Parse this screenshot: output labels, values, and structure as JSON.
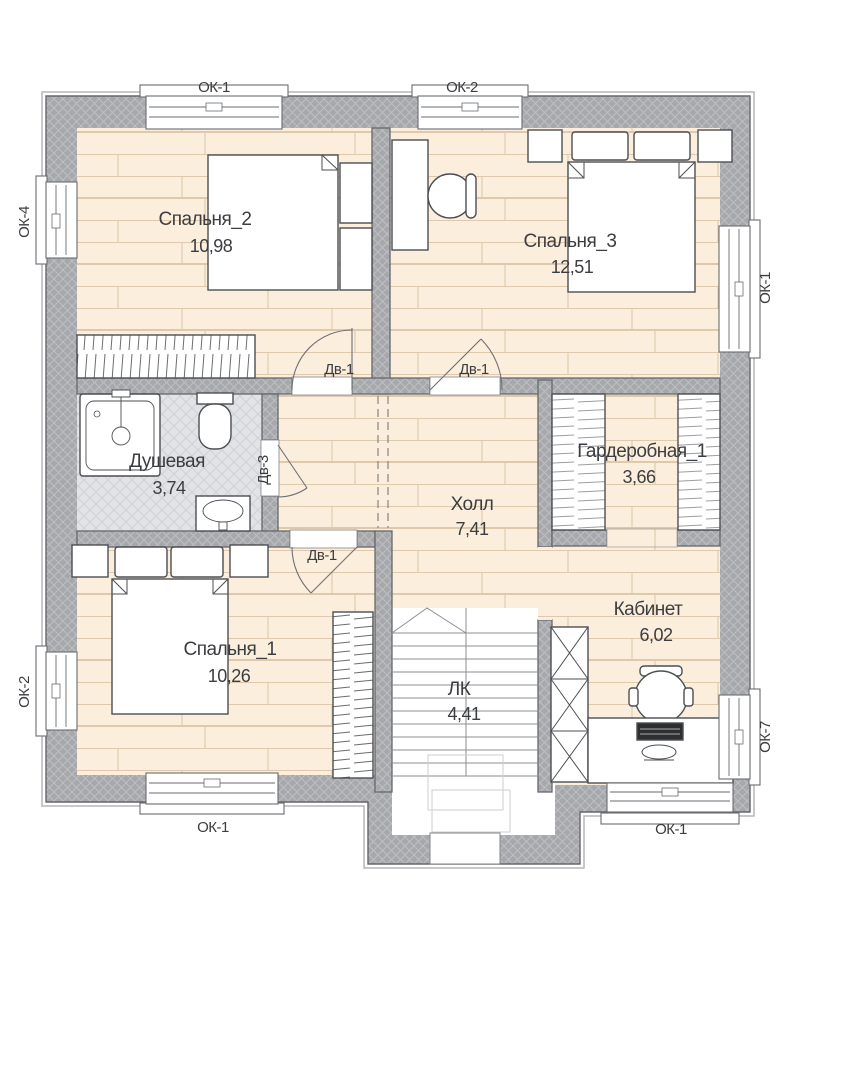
{
  "rooms": {
    "bedroom2": {
      "name": "Спальня_2",
      "area": "10,98"
    },
    "bedroom3": {
      "name": "Спальня_3",
      "area": "12,51"
    },
    "shower": {
      "name": "Душевая",
      "area": "3,74"
    },
    "hall": {
      "name": "Холл",
      "area": "7,41"
    },
    "wardrobe": {
      "name": "Гардеробная_1",
      "area": "3,66"
    },
    "bedroom1": {
      "name": "Спальня_1",
      "area": "10,26"
    },
    "office": {
      "name": "Кабинет",
      "area": "6,02"
    },
    "stairs": {
      "name": "ЛК",
      "area": "4,41"
    }
  },
  "windows": {
    "top_left": "ОК-1",
    "top_center": "ОК-2",
    "left_upper": "ОК-4",
    "right_upper": "ОК-1",
    "left_lower": "ОК-2",
    "bottom_left": "ОК-1",
    "bottom_right": "ОК-1",
    "right_lower": "ОК-7"
  },
  "doors": {
    "bedroom2": "Дв-1",
    "bedroom3": "Дв-1",
    "bedroom1": "Дв-1",
    "shower": "Дв-3"
  },
  "colors": {
    "wall_fill": "#a6a8ab",
    "wall_hatch": "#bdbfc2",
    "wall_line": "#66676b",
    "floor_wood": "#fbeedd",
    "floor_wood_line": "#dec9ad",
    "floor_tile": "#e2e3e6",
    "furniture_line": "#4d4e52",
    "text": "#3c3d40"
  }
}
